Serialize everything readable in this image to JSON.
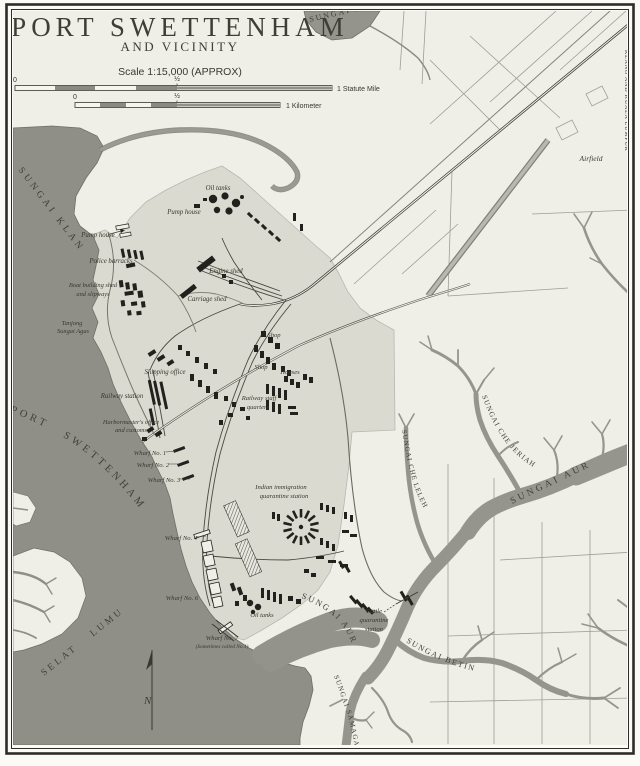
{
  "title": {
    "main": "PORT SWETTENHAM",
    "sub": "AND VICINITY"
  },
  "scale": {
    "text": "Scale 1:15,000 (APPROX)",
    "mile": {
      "zero": "0",
      "half": "½",
      "end": "1 Statute Mile"
    },
    "km": {
      "zero": "0",
      "half": "½",
      "end": "1 Kilometer"
    }
  },
  "compass": {
    "north": "N"
  },
  "water_labels": {
    "sungai_klang_top": "SUNGAI KLANG",
    "sungai_klang_left": "SUNGAI KLANG",
    "port_swettenham_roads": "PORT SWETTENHAM ROADS",
    "selat_lumut": "SELAT LUMUT",
    "sungai_che_jeriah": "SUNGAI CHE JERIAH",
    "sungai_che_leleh": "SUNGAI CHE LELEH",
    "sungai_aur_upper": "SUNGAI AUR",
    "sungai_aur_lower": "SUNGAI AUR",
    "sungai_beting": "SUNGAI BETING",
    "sungai_samagaga": "SUNGAI SAMAGAGA",
    "klang_kuala_lumpur": "KLANG AND KUALA LUMPUR"
  },
  "place_labels": {
    "airfield": "Airfield",
    "oil_tanks_north": "Oil tanks",
    "pump_house_north": "Pump house",
    "pump_house_west": "Pump house",
    "police_barracks": "Police barracks",
    "boat_building_1": "Boat building shed",
    "boat_building_2": "and slipways",
    "tanjong_1": "Tanjong",
    "tanjong_2": "Sungai Agas",
    "engine_shed": "Engine shed",
    "carriage_shed": "Carriage shed",
    "shop_north": "Shop",
    "shop_south": "Shop",
    "houses": "Houses",
    "shipping_office": "Shipping office",
    "railway_station": "Railway station",
    "harbormaster_1": "Harbormaster's office",
    "harbormaster_2": "and customs",
    "railway_staff_1": "Railway staff",
    "railway_staff_2": "quarters",
    "wharf_1": "Wharf No. 1",
    "wharf_2": "Wharf No. 2",
    "wharf_3": "Wharf No. 3",
    "wharf_4": "Wharf No. 4",
    "wharf_6": "Wharf No. 6",
    "wharf_7_1": "Wharf No. 7",
    "wharf_7_2": "(Sometimes called No.1)",
    "oil_tanks_south": "Oil tanks",
    "indian_imm_1": "Indian immigration",
    "indian_imm_2": "quarantine station",
    "cattle_1": "Cattle",
    "cattle_2": "quarantine",
    "cattle_3": "station"
  },
  "palette": {
    "paper": "#efeee7",
    "water": "#8f8f88",
    "river": "#96958d",
    "town_shade": "#dadad1",
    "ink": "#39382f",
    "building": "#21211d",
    "frame": "#2e2d28"
  }
}
